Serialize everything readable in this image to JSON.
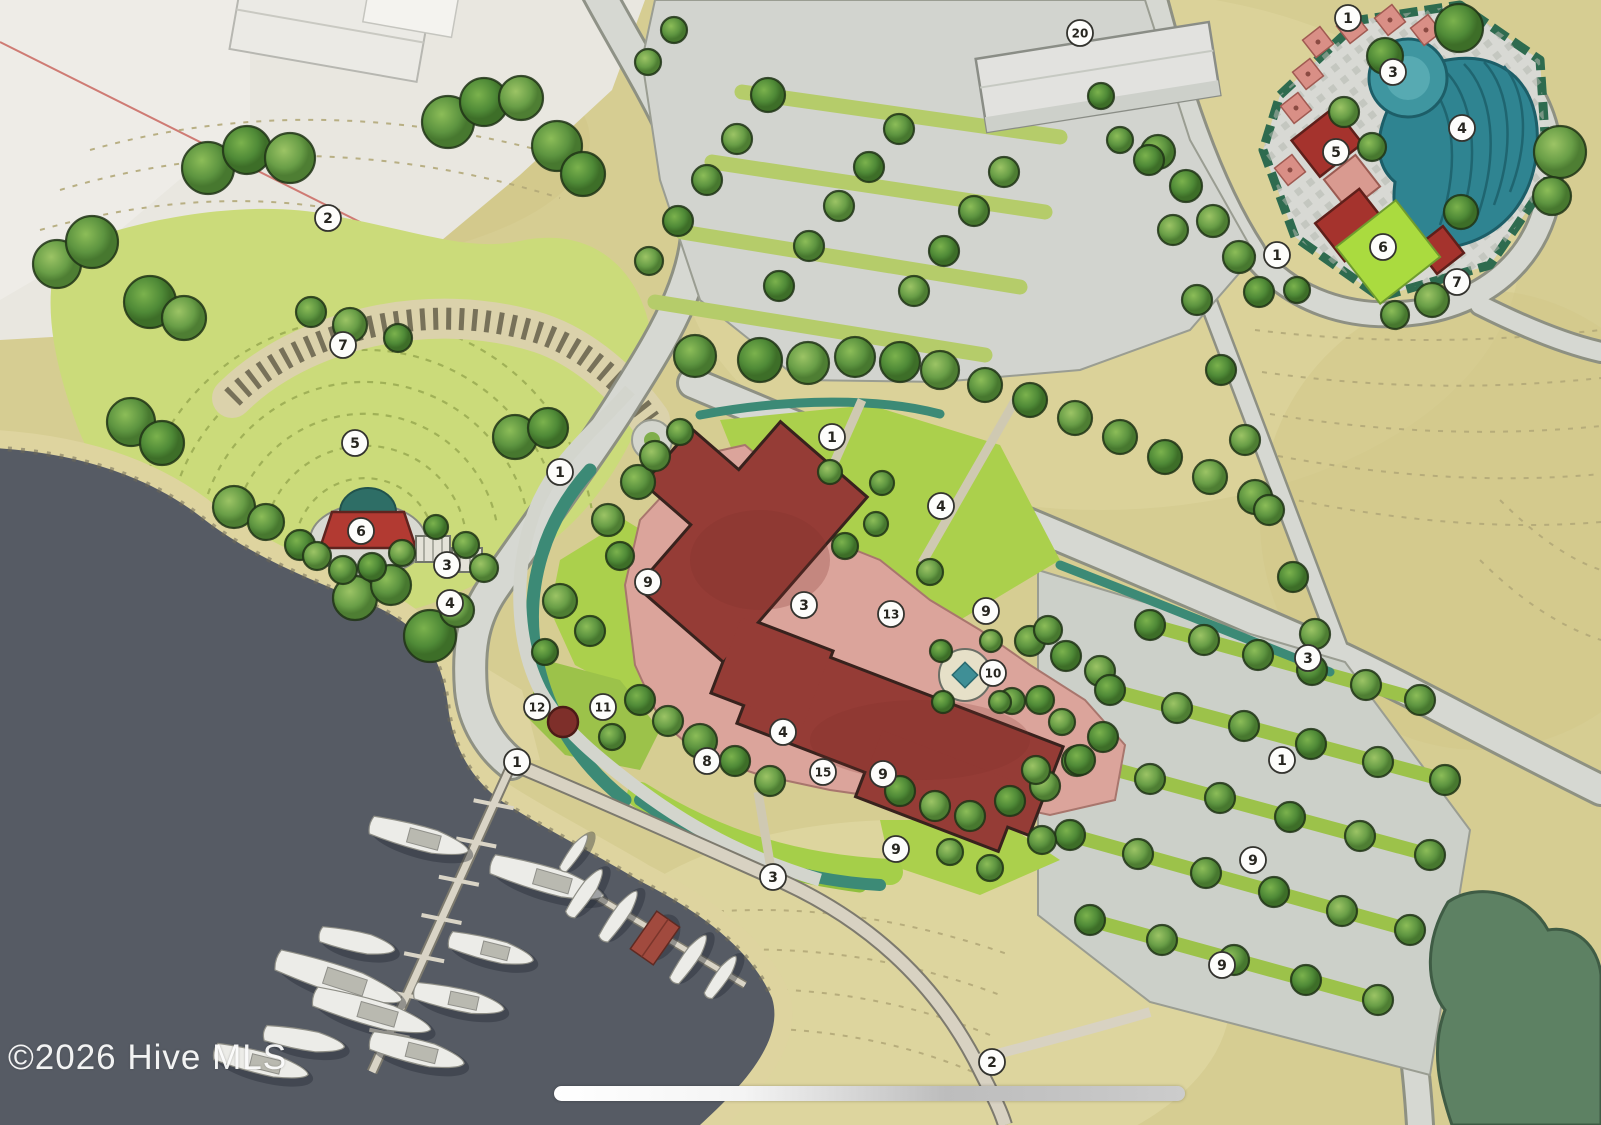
{
  "watermark": {
    "text": "©2026 Hive MLS"
  },
  "map": {
    "type": "site-plan",
    "style": "hand-drawn watercolor community master plan with marina, amphitheater, clubhouse, pool complex and parking",
    "colors": {
      "water": "#565b64",
      "meadow": "#d6cd92",
      "bowl_lawn": "#cbdb7a",
      "lawn": "#abd04c",
      "road": "#d6d8d2",
      "building_red": "#953c36",
      "terrace_pink": "#dba49b",
      "pool_teal": "#2f8491",
      "hedge_teal": "#3c8a76",
      "tree_green": "#4f8a33",
      "forest": "#5d8163",
      "sand": "#ded49f",
      "marker_bg": "#ffffff"
    },
    "markers": [
      {
        "x": 328,
        "y": 218,
        "label": "2"
      },
      {
        "x": 343,
        "y": 345,
        "label": "7"
      },
      {
        "x": 355,
        "y": 443,
        "label": "5"
      },
      {
        "x": 361,
        "y": 531,
        "label": "6"
      },
      {
        "x": 447,
        "y": 565,
        "label": "3"
      },
      {
        "x": 450,
        "y": 603,
        "label": "4"
      },
      {
        "x": 560,
        "y": 472,
        "label": "1"
      },
      {
        "x": 1080,
        "y": 33,
        "label": "20"
      },
      {
        "x": 832,
        "y": 437,
        "label": "1"
      },
      {
        "x": 941,
        "y": 506,
        "label": "4"
      },
      {
        "x": 648,
        "y": 582,
        "label": "9"
      },
      {
        "x": 804,
        "y": 605,
        "label": "3"
      },
      {
        "x": 891,
        "y": 614,
        "label": "13"
      },
      {
        "x": 986,
        "y": 611,
        "label": "9"
      },
      {
        "x": 993,
        "y": 673,
        "label": "10"
      },
      {
        "x": 537,
        "y": 707,
        "label": "12"
      },
      {
        "x": 603,
        "y": 707,
        "label": "11"
      },
      {
        "x": 783,
        "y": 732,
        "label": "4"
      },
      {
        "x": 707,
        "y": 761,
        "label": "8"
      },
      {
        "x": 823,
        "y": 772,
        "label": "15"
      },
      {
        "x": 883,
        "y": 774,
        "label": "9"
      },
      {
        "x": 896,
        "y": 849,
        "label": "9"
      },
      {
        "x": 773,
        "y": 877,
        "label": "3"
      },
      {
        "x": 517,
        "y": 762,
        "label": "1"
      },
      {
        "x": 1348,
        "y": 18,
        "label": "1"
      },
      {
        "x": 1393,
        "y": 72,
        "label": "3"
      },
      {
        "x": 1462,
        "y": 128,
        "label": "4"
      },
      {
        "x": 1336,
        "y": 152,
        "label": "5"
      },
      {
        "x": 1383,
        "y": 247,
        "label": "6"
      },
      {
        "x": 1457,
        "y": 282,
        "label": "7"
      },
      {
        "x": 1277,
        "y": 255,
        "label": "1"
      },
      {
        "x": 1308,
        "y": 658,
        "label": "3"
      },
      {
        "x": 1282,
        "y": 760,
        "label": "1"
      },
      {
        "x": 1253,
        "y": 860,
        "label": "9"
      },
      {
        "x": 1222,
        "y": 965,
        "label": "9"
      },
      {
        "x": 992,
        "y": 1062,
        "label": "2"
      }
    ],
    "trees": [
      [
        208,
        168,
        26
      ],
      [
        247,
        150,
        24
      ],
      [
        290,
        158,
        25
      ],
      [
        448,
        122,
        26
      ],
      [
        484,
        102,
        24
      ],
      [
        521,
        98,
        22
      ],
      [
        557,
        146,
        25
      ],
      [
        583,
        174,
        22
      ],
      [
        57,
        264,
        24
      ],
      [
        92,
        242,
        26
      ],
      [
        150,
        302,
        26
      ],
      [
        184,
        318,
        22
      ],
      [
        131,
        422,
        24
      ],
      [
        162,
        443,
        22
      ],
      [
        234,
        507,
        21
      ],
      [
        266,
        522,
        18
      ],
      [
        300,
        545,
        15
      ],
      [
        355,
        598,
        22
      ],
      [
        391,
        585,
        20
      ],
      [
        430,
        636,
        26
      ],
      [
        457,
        610,
        17
      ],
      [
        515,
        437,
        22
      ],
      [
        548,
        428,
        20
      ],
      [
        350,
        325,
        17
      ],
      [
        311,
        312,
        15
      ],
      [
        398,
        338,
        14
      ],
      [
        317,
        556,
        14
      ],
      [
        343,
        570,
        14
      ],
      [
        372,
        567,
        14
      ],
      [
        402,
        553,
        13
      ],
      [
        466,
        545,
        13
      ],
      [
        436,
        527,
        12
      ],
      [
        484,
        568,
        14
      ],
      [
        695,
        356,
        21
      ],
      [
        760,
        360,
        22
      ],
      [
        808,
        363,
        21
      ],
      [
        855,
        357,
        20
      ],
      [
        900,
        362,
        20
      ],
      [
        940,
        370,
        19
      ],
      [
        985,
        385,
        17
      ],
      [
        1030,
        400,
        17
      ],
      [
        1075,
        418,
        17
      ],
      [
        1120,
        437,
        17
      ],
      [
        1165,
        457,
        17
      ],
      [
        1210,
        477,
        17
      ],
      [
        1255,
        497,
        17
      ],
      [
        768,
        95,
        17
      ],
      [
        737,
        139,
        15
      ],
      [
        707,
        180,
        15
      ],
      [
        678,
        221,
        15
      ],
      [
        649,
        261,
        14
      ],
      [
        899,
        129,
        15
      ],
      [
        869,
        167,
        15
      ],
      [
        839,
        206,
        15
      ],
      [
        809,
        246,
        15
      ],
      [
        779,
        286,
        15
      ],
      [
        1004,
        172,
        15
      ],
      [
        974,
        211,
        15
      ],
      [
        944,
        251,
        15
      ],
      [
        914,
        291,
        15
      ],
      [
        1158,
        152,
        17
      ],
      [
        1186,
        186,
        16
      ],
      [
        1213,
        221,
        16
      ],
      [
        1239,
        257,
        16
      ],
      [
        1259,
        292,
        15
      ],
      [
        648,
        62,
        13
      ],
      [
        674,
        30,
        13
      ],
      [
        1149,
        160,
        15
      ],
      [
        1173,
        230,
        15
      ],
      [
        1197,
        300,
        15
      ],
      [
        1221,
        370,
        15
      ],
      [
        1245,
        440,
        15
      ],
      [
        1269,
        510,
        15
      ],
      [
        1293,
        577,
        15
      ],
      [
        1315,
        634,
        15
      ],
      [
        1120,
        140,
        13
      ],
      [
        1101,
        96,
        13
      ],
      [
        608,
        520,
        16
      ],
      [
        638,
        482,
        17
      ],
      [
        620,
        556,
        14
      ],
      [
        560,
        601,
        17
      ],
      [
        590,
        631,
        15
      ],
      [
        545,
        652,
        13
      ],
      [
        655,
        456,
        15
      ],
      [
        680,
        432,
        13
      ],
      [
        640,
        700,
        15
      ],
      [
        668,
        721,
        15
      ],
      [
        700,
        741,
        17
      ],
      [
        735,
        761,
        15
      ],
      [
        770,
        781,
        15
      ],
      [
        612,
        737,
        13
      ],
      [
        900,
        791,
        15
      ],
      [
        935,
        806,
        15
      ],
      [
        970,
        816,
        15
      ],
      [
        1010,
        801,
        15
      ],
      [
        1045,
        786,
        15
      ],
      [
        1077,
        761,
        15
      ],
      [
        1103,
        737,
        15
      ],
      [
        1062,
        722,
        13
      ],
      [
        1030,
        641,
        15
      ],
      [
        1066,
        656,
        15
      ],
      [
        1100,
        671,
        15
      ],
      [
        1012,
        701,
        13
      ],
      [
        845,
        546,
        13
      ],
      [
        930,
        572,
        13
      ],
      [
        876,
        524,
        12
      ],
      [
        941,
        651,
        11
      ],
      [
        991,
        641,
        11
      ],
      [
        1000,
        702,
        11
      ],
      [
        943,
        702,
        11
      ],
      [
        830,
        472,
        12
      ],
      [
        882,
        483,
        12
      ],
      [
        1150,
        625,
        15
      ],
      [
        1204,
        640,
        15
      ],
      [
        1258,
        655,
        15
      ],
      [
        1312,
        670,
        15
      ],
      [
        1366,
        685,
        15
      ],
      [
        1420,
        700,
        15
      ],
      [
        1110,
        690,
        15
      ],
      [
        1177,
        708,
        15
      ],
      [
        1244,
        726,
        15
      ],
      [
        1311,
        744,
        15
      ],
      [
        1378,
        762,
        15
      ],
      [
        1445,
        780,
        15
      ],
      [
        1080,
        760,
        15
      ],
      [
        1150,
        779,
        15
      ],
      [
        1220,
        798,
        15
      ],
      [
        1290,
        817,
        15
      ],
      [
        1360,
        836,
        15
      ],
      [
        1430,
        855,
        15
      ],
      [
        1070,
        835,
        15
      ],
      [
        1138,
        854,
        15
      ],
      [
        1206,
        873,
        15
      ],
      [
        1274,
        892,
        15
      ],
      [
        1342,
        911,
        15
      ],
      [
        1410,
        930,
        15
      ],
      [
        1090,
        920,
        15
      ],
      [
        1162,
        940,
        15
      ],
      [
        1234,
        960,
        15
      ],
      [
        1306,
        980,
        15
      ],
      [
        1378,
        1000,
        15
      ],
      [
        1048,
        630,
        14
      ],
      [
        1040,
        700,
        14
      ],
      [
        1036,
        770,
        14
      ],
      [
        1042,
        840,
        14
      ],
      [
        1459,
        28,
        24
      ],
      [
        1560,
        152,
        26
      ],
      [
        1552,
        196,
        19
      ],
      [
        1385,
        56,
        18
      ],
      [
        1344,
        112,
        15
      ],
      [
        1372,
        147,
        14
      ],
      [
        1461,
        212,
        17
      ],
      [
        1432,
        300,
        17
      ],
      [
        1395,
        315,
        14
      ],
      [
        1297,
        290,
        13
      ],
      [
        950,
        852,
        13
      ],
      [
        990,
        868,
        13
      ]
    ],
    "boats": [
      [
        420,
        838,
        100,
        26,
        15,
        "b"
      ],
      [
        548,
        880,
        115,
        28,
        16,
        "b"
      ],
      [
        358,
        942,
        75,
        22,
        12,
        "b"
      ],
      [
        492,
        950,
        85,
        24,
        14,
        "b"
      ],
      [
        340,
        980,
        130,
        30,
        18,
        "b"
      ],
      [
        373,
        1013,
        120,
        28,
        16,
        "b"
      ],
      [
        460,
        1000,
        90,
        24,
        12,
        "b"
      ],
      [
        305,
        1040,
        80,
        22,
        10,
        "b"
      ],
      [
        262,
        1063,
        95,
        24,
        14,
        "b"
      ],
      [
        418,
        1052,
        95,
        26,
        14,
        "b"
      ],
      [
        575,
        852,
        42,
        12,
        -55,
        "b"
      ],
      [
        586,
        892,
        55,
        16,
        -55,
        "b"
      ],
      [
        620,
        915,
        58,
        16,
        -55,
        "b"
      ],
      [
        655,
        938,
        46,
        28,
        -55,
        "h"
      ],
      [
        690,
        958,
        55,
        16,
        -55,
        "b"
      ],
      [
        722,
        976,
        48,
        14,
        -55,
        "b"
      ]
    ]
  },
  "ui": {
    "scroll_indicator_visible": true
  }
}
